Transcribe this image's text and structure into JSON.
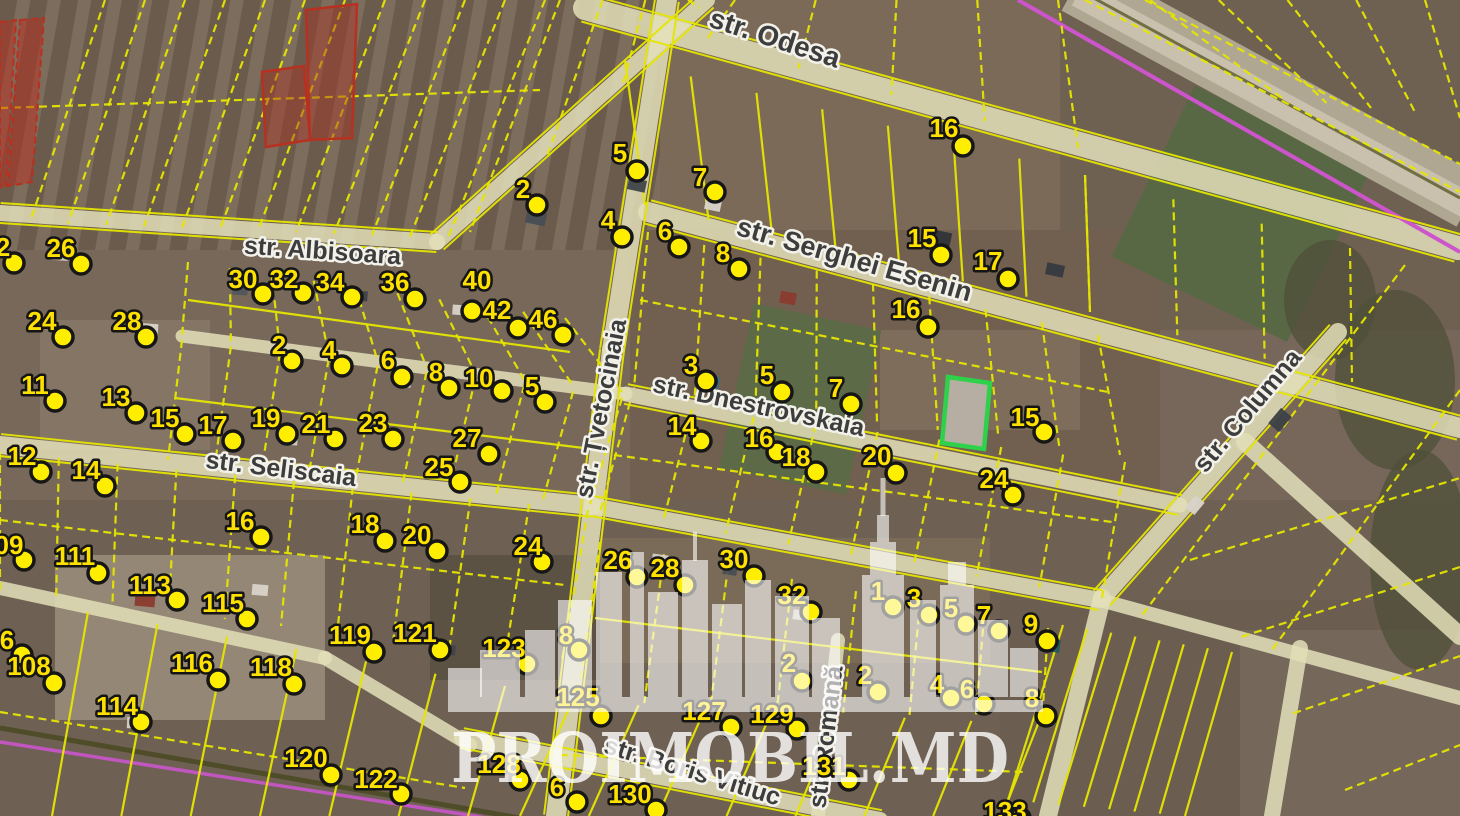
{
  "map": {
    "provider_watermark": {
      "text": "PROIMOBIL.MD"
    },
    "highlight_parcel": {
      "border_color": "#2ed24a",
      "fill_color": "#b9b2a6"
    },
    "colors": {
      "parcel_line": "#e6e600",
      "marker_fill": "#ffee00",
      "marker_text": "#ffe100",
      "street_text": "#3d3d3d",
      "road_fill": "#e3dfb8",
      "railway_line": "#cc55cc",
      "restricted_parcel": "#b83020"
    },
    "streets": [
      {
        "name": "str. Odesa",
        "x": 772,
        "y": 47,
        "rot": 18,
        "size": 28
      },
      {
        "name": "str. Serghei Esenin",
        "x": 852,
        "y": 268,
        "rot": 16,
        "size": 27
      },
      {
        "name": "str. Albisoara",
        "x": 322,
        "y": 259,
        "rot": 4,
        "size": 25
      },
      {
        "name": "str. Dnestrovskaia",
        "x": 757,
        "y": 414,
        "rot": 12,
        "size": 25
      },
      {
        "name": "str. Seliscaia",
        "x": 280,
        "y": 477,
        "rot": 7,
        "size": 25
      },
      {
        "name": "str. Țvetocinaia",
        "x": 609,
        "y": 410,
        "rot": -79,
        "size": 25
      },
      {
        "name": "str. Columna",
        "x": 1254,
        "y": 416,
        "rot": -50,
        "size": 25
      },
      {
        "name": "str. Boris Vitiuc",
        "x": 690,
        "y": 779,
        "rot": 17,
        "size": 25
      },
      {
        "name": "str. Romană",
        "x": 834,
        "y": 738,
        "rot": -83,
        "size": 25
      }
    ],
    "markers": [
      {
        "n": "5",
        "lx": 620,
        "ly": 153,
        "dx": 637,
        "dy": 171
      },
      {
        "n": "7",
        "lx": 700,
        "ly": 177,
        "dx": 715,
        "dy": 192
      },
      {
        "n": "16",
        "lx": 944,
        "ly": 128,
        "dx": 963,
        "dy": 146
      },
      {
        "n": "2",
        "lx": 523,
        "ly": 189,
        "dx": 537,
        "dy": 205
      },
      {
        "n": "4",
        "lx": 608,
        "ly": 220,
        "dx": 622,
        "dy": 237
      },
      {
        "n": "6",
        "lx": 665,
        "ly": 231,
        "dx": 679,
        "dy": 247
      },
      {
        "n": "8",
        "lx": 723,
        "ly": 253,
        "dx": 739,
        "dy": 269
      },
      {
        "n": "15",
        "lx": 922,
        "ly": 238,
        "dx": 941,
        "dy": 255
      },
      {
        "n": "17",
        "lx": 988,
        "ly": 261,
        "dx": 1008,
        "dy": 279
      },
      {
        "n": "16",
        "lx": 906,
        "ly": 309,
        "dx": 928,
        "dy": 327
      },
      {
        "n": "30",
        "lx": 243,
        "ly": 279,
        "dx": 263,
        "dy": 294
      },
      {
        "n": "32",
        "lx": 284,
        "ly": 279,
        "dx": 303,
        "dy": 293
      },
      {
        "n": "34",
        "lx": 330,
        "ly": 282,
        "dx": 352,
        "dy": 297
      },
      {
        "n": "36",
        "lx": 395,
        "ly": 282,
        "dx": 415,
        "dy": 299
      },
      {
        "n": "40",
        "lx": 477,
        "ly": 280,
        "dx": 472,
        "dy": 311
      },
      {
        "n": "42",
        "lx": 497,
        "ly": 310,
        "dx": 518,
        "dy": 328
      },
      {
        "n": "46",
        "lx": 543,
        "ly": 319,
        "dx": 563,
        "dy": 335
      },
      {
        "n": "2",
        "lx": 279,
        "ly": 345,
        "dx": 292,
        "dy": 361
      },
      {
        "n": "4",
        "lx": 329,
        "ly": 350,
        "dx": 342,
        "dy": 366
      },
      {
        "n": "6",
        "lx": 388,
        "ly": 360,
        "dx": 402,
        "dy": 377
      },
      {
        "n": "8",
        "lx": 436,
        "ly": 372,
        "dx": 449,
        "dy": 388
      },
      {
        "n": "10",
        "lx": 479,
        "ly": 378,
        "dx": 502,
        "dy": 391
      },
      {
        "n": "5",
        "lx": 532,
        "ly": 386,
        "dx": 545,
        "dy": 402
      },
      {
        "n": "2",
        "lx": 3,
        "ly": 247,
        "dx": 14,
        "dy": 263
      },
      {
        "n": "26",
        "lx": 61,
        "ly": 248,
        "dx": 81,
        "dy": 264
      },
      {
        "n": "24",
        "lx": 42,
        "ly": 321,
        "dx": 63,
        "dy": 337
      },
      {
        "n": "28",
        "lx": 127,
        "ly": 321,
        "dx": 146,
        "dy": 337
      },
      {
        "n": "11",
        "lx": 35,
        "ly": 385,
        "dx": 55,
        "dy": 401
      },
      {
        "n": "13",
        "lx": 116,
        "ly": 397,
        "dx": 136,
        "dy": 413
      },
      {
        "n": "15",
        "lx": 165,
        "ly": 418,
        "dx": 185,
        "dy": 434
      },
      {
        "n": "17",
        "lx": 213,
        "ly": 425,
        "dx": 233,
        "dy": 441
      },
      {
        "n": "12",
        "lx": 22,
        "ly": 456,
        "dx": 41,
        "dy": 472
      },
      {
        "n": "14",
        "lx": 86,
        "ly": 470,
        "dx": 105,
        "dy": 486
      },
      {
        "n": "19",
        "lx": 266,
        "ly": 418,
        "dx": 287,
        "dy": 434
      },
      {
        "n": "21",
        "lx": 316,
        "ly": 424,
        "dx": 335,
        "dy": 439
      },
      {
        "n": "23",
        "lx": 373,
        "ly": 423,
        "dx": 393,
        "dy": 439
      },
      {
        "n": "27",
        "lx": 467,
        "ly": 438,
        "dx": 489,
        "dy": 454
      },
      {
        "n": "25",
        "lx": 439,
        "ly": 467,
        "dx": 460,
        "dy": 482
      },
      {
        "n": "16",
        "lx": 240,
        "ly": 521,
        "dx": 261,
        "dy": 537
      },
      {
        "n": "18",
        "lx": 365,
        "ly": 524,
        "dx": 385,
        "dy": 541
      },
      {
        "n": "20",
        "lx": 417,
        "ly": 535,
        "dx": 437,
        "dy": 551
      },
      {
        "n": "24",
        "lx": 528,
        "ly": 546,
        "dx": 542,
        "dy": 562
      },
      {
        "n": "3",
        "lx": 691,
        "ly": 365,
        "dx": 706,
        "dy": 381
      },
      {
        "n": "5",
        "lx": 767,
        "ly": 375,
        "dx": 782,
        "dy": 392
      },
      {
        "n": "7",
        "lx": 836,
        "ly": 388,
        "dx": 851,
        "dy": 404
      },
      {
        "n": "14",
        "lx": 682,
        "ly": 426,
        "dx": 701,
        "dy": 441
      },
      {
        "n": "16",
        "lx": 759,
        "ly": 438,
        "dx": 777,
        "dy": 452
      },
      {
        "n": "18",
        "lx": 796,
        "ly": 457,
        "dx": 816,
        "dy": 472
      },
      {
        "n": "20",
        "lx": 877,
        "ly": 456,
        "dx": 896,
        "dy": 473
      },
      {
        "n": "15",
        "lx": 1025,
        "ly": 417,
        "dx": 1044,
        "dy": 432
      },
      {
        "n": "24",
        "lx": 994,
        "ly": 479,
        "dx": 1013,
        "dy": 495
      },
      {
        "n": "09",
        "lx": 9,
        "ly": 545,
        "dx": 24,
        "dy": 560
      },
      {
        "n": "111",
        "lx": 75,
        "ly": 556,
        "dx": 98,
        "dy": 573
      },
      {
        "n": "113",
        "lx": 150,
        "ly": 585,
        "dx": 177,
        "dy": 600
      },
      {
        "n": "115",
        "lx": 223,
        "ly": 603,
        "dx": 247,
        "dy": 619
      },
      {
        "n": "6",
        "lx": 7,
        "ly": 640,
        "dx": 22,
        "dy": 655
      },
      {
        "n": "108",
        "lx": 29,
        "ly": 666,
        "dx": 54,
        "dy": 683
      },
      {
        "n": "116",
        "lx": 192,
        "ly": 663,
        "dx": 218,
        "dy": 680
      },
      {
        "n": "118",
        "lx": 271,
        "ly": 667,
        "dx": 294,
        "dy": 684
      },
      {
        "n": "114",
        "lx": 117,
        "ly": 706,
        "dx": 141,
        "dy": 722
      },
      {
        "n": "120",
        "lx": 306,
        "ly": 758,
        "dx": 331,
        "dy": 775
      },
      {
        "n": "122",
        "lx": 376,
        "ly": 779,
        "dx": 401,
        "dy": 794
      },
      {
        "n": "119",
        "lx": 350,
        "ly": 635,
        "dx": 374,
        "dy": 652
      },
      {
        "n": "121",
        "lx": 415,
        "ly": 633,
        "dx": 440,
        "dy": 650
      },
      {
        "n": "123",
        "lx": 504,
        "ly": 648,
        "dx": 527,
        "dy": 664
      },
      {
        "n": "8",
        "lx": 566,
        "ly": 635,
        "dx": 579,
        "dy": 650
      },
      {
        "n": "26",
        "lx": 618,
        "ly": 560,
        "dx": 637,
        "dy": 577
      },
      {
        "n": "28",
        "lx": 665,
        "ly": 568,
        "dx": 685,
        "dy": 585
      },
      {
        "n": "30",
        "lx": 734,
        "ly": 559,
        "dx": 754,
        "dy": 576
      },
      {
        "n": "32",
        "lx": 792,
        "ly": 595,
        "dx": 811,
        "dy": 612
      },
      {
        "n": "1",
        "lx": 878,
        "ly": 591,
        "dx": 893,
        "dy": 607
      },
      {
        "n": "3",
        "lx": 914,
        "ly": 598,
        "dx": 929,
        "dy": 615
      },
      {
        "n": "5",
        "lx": 951,
        "ly": 608,
        "dx": 966,
        "dy": 624
      },
      {
        "n": "7",
        "lx": 984,
        "ly": 615,
        "dx": 999,
        "dy": 631
      },
      {
        "n": "9",
        "lx": 1031,
        "ly": 624,
        "dx": 1047,
        "dy": 641
      },
      {
        "n": "2",
        "lx": 789,
        "ly": 663,
        "dx": 802,
        "dy": 681
      },
      {
        "n": "2",
        "lx": 865,
        "ly": 675,
        "dx": 878,
        "dy": 692
      },
      {
        "n": "4",
        "lx": 937,
        "ly": 684,
        "dx": 951,
        "dy": 698
      },
      {
        "n": "6",
        "lx": 967,
        "ly": 689,
        "dx": 984,
        "dy": 704
      },
      {
        "n": "8",
        "lx": 1032,
        "ly": 698,
        "dx": 1046,
        "dy": 716
      },
      {
        "n": "125",
        "lx": 578,
        "ly": 697,
        "dx": 601,
        "dy": 716
      },
      {
        "n": "127",
        "lx": 704,
        "ly": 711,
        "dx": 731,
        "dy": 727
      },
      {
        "n": "129",
        "lx": 772,
        "ly": 714,
        "dx": 797,
        "dy": 729
      },
      {
        "n": "131",
        "lx": 824,
        "ly": 766,
        "dx": 849,
        "dy": 780
      },
      {
        "n": "128",
        "lx": 499,
        "ly": 764,
        "dx": 520,
        "dy": 780
      },
      {
        "n": "6",
        "lx": 557,
        "ly": 787,
        "dx": 577,
        "dy": 802
      },
      {
        "n": "130",
        "lx": 630,
        "ly": 794,
        "dx": 656,
        "dy": 810
      },
      {
        "n": "133",
        "lx": 1005,
        "ly": 811,
        "dx": 1020,
        "dy": 818
      }
    ]
  }
}
